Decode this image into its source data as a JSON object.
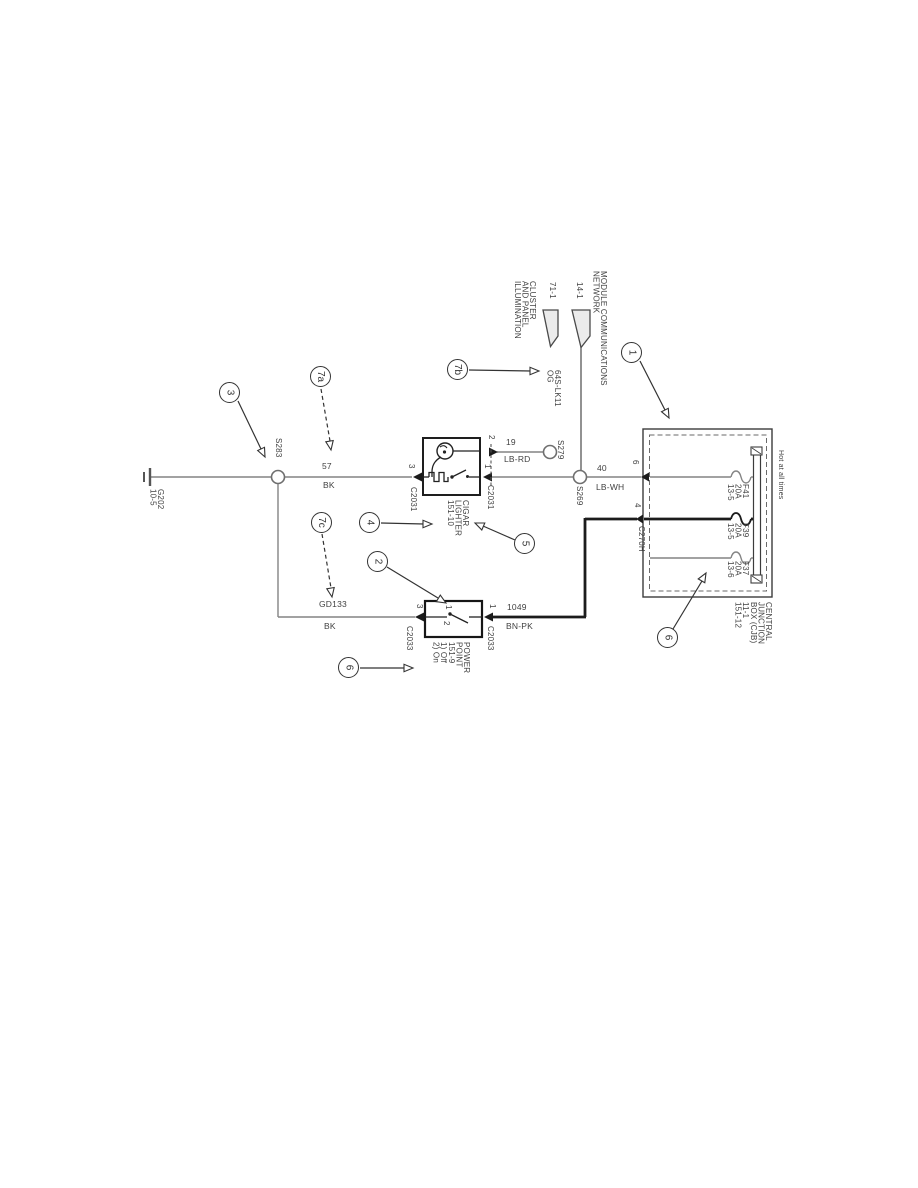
{
  "colors": {
    "wire_thin": "#848484",
    "wire_thick": "#1c1c1c",
    "outline": "#3c3c3c",
    "text": "#414141"
  },
  "balloons": {
    "b1": "1",
    "b2": "2",
    "b3": "3",
    "b4": "4",
    "b5": "5",
    "b6_power_point": "6",
    "b6_cjb": "6",
    "b7a": "7a",
    "b7b": "7b",
    "b7c": "7c"
  },
  "offpage_refs": {
    "illumination": {
      "page": "71-1",
      "label": "CLUSTER\nAND PANEL\nILLUMINATION"
    },
    "network": {
      "page": "14-1",
      "label": "MODULE COMMUNICATIONS\nNETWORK"
    }
  },
  "junction_box": {
    "hot_label": "Hot at all times",
    "label": "CENTRAL\nJUNCTION\nBOX (CJB)\n11-1\n151-12",
    "connector": "C270H",
    "pin6": "6",
    "pin4": "4",
    "fuses": [
      {
        "label": "F41\n20A\n13-5"
      },
      {
        "label": "F39\n20A\n13-5"
      },
      {
        "label": "F37\n20A\n13-6"
      }
    ]
  },
  "cigar_lighter": {
    "label": "CIGAR\nLIGHTER\n151-10",
    "pin3": "3",
    "pin1": "1",
    "pin2": "2",
    "connector_left": "C2031",
    "connector_right": "C2031"
  },
  "power_point": {
    "label": "POWER\nPOINT\n151-9\n1) Off\n2) On",
    "pin3": "3",
    "pin1": "1",
    "pos1": "1",
    "pos2": "2",
    "connector_left": "C2033",
    "connector_right": "C2033"
  },
  "wires": {
    "w57": {
      "circuit": "57",
      "color": "BK"
    },
    "w19": {
      "circuit": "19",
      "color": "LB-RD"
    },
    "w40": {
      "circuit": "40",
      "color": "LB-WH"
    },
    "w1049": {
      "circuit": "1049",
      "color": "BN-PK"
    },
    "gd133": {
      "circuit": "GD133",
      "color": "BK"
    },
    "w64s": {
      "label": "64S-LK11\nOG"
    }
  },
  "splices": {
    "s283": "S283",
    "s269": "S269",
    "s279": "S279"
  },
  "ground": {
    "label": "G202\n10-5"
  }
}
